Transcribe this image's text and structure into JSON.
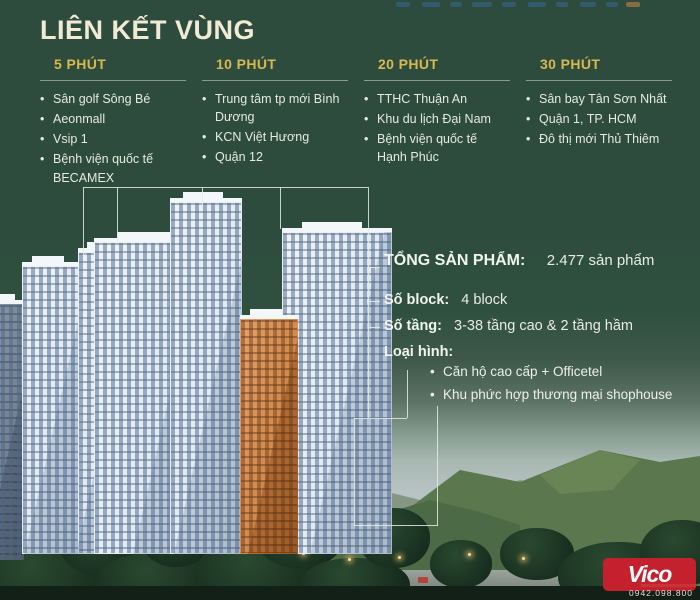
{
  "title": "LIÊN KẾT VÙNG",
  "columns": [
    {
      "header": "5 PHÚT",
      "items": [
        "Sân golf Sông Bé",
        "Aeonmall",
        "Vsip 1",
        "Bệnh viện quốc tế BECAMEX"
      ]
    },
    {
      "header": "10 PHÚT",
      "items": [
        "Trung tâm tp mới Bình Dương",
        "KCN Việt Hương",
        "Quận 12"
      ]
    },
    {
      "header": "20 PHÚT",
      "items": [
        "TTHC Thuận An",
        "Khu du lịch Đại Nam",
        "Bệnh viện quốc tế Hạnh Phúc"
      ]
    },
    {
      "header": "30 PHÚT",
      "items": [
        "Sân bay Tân Sơn Nhất",
        "Quận 1, TP. HCM",
        "Đô thị mới Thủ Thiêm"
      ]
    }
  ],
  "info": {
    "total_label": "TỔNG SẢN PHẨM:",
    "total_value": "2.477 sản phẩm",
    "block_label": "Số block:",
    "block_value": "4 block",
    "floors_label": "Số tầng:",
    "floors_value": "3-38 tầng cao & 2 tầng hầm",
    "type_label": "Loại hình:",
    "types": [
      "Căn hộ cao cấp + Officetel",
      "Khu phức hợp thương mại shophouse"
    ]
  },
  "branding": {
    "logo_text": "Vico",
    "phone": "0942.098.800",
    "logo_color": "#c4202e"
  },
  "colors": {
    "background_green": "#2d4c3e",
    "accent_gold": "#d9b84e",
    "title_cream": "#f1ebd6",
    "body_text": "#e7eadf"
  }
}
